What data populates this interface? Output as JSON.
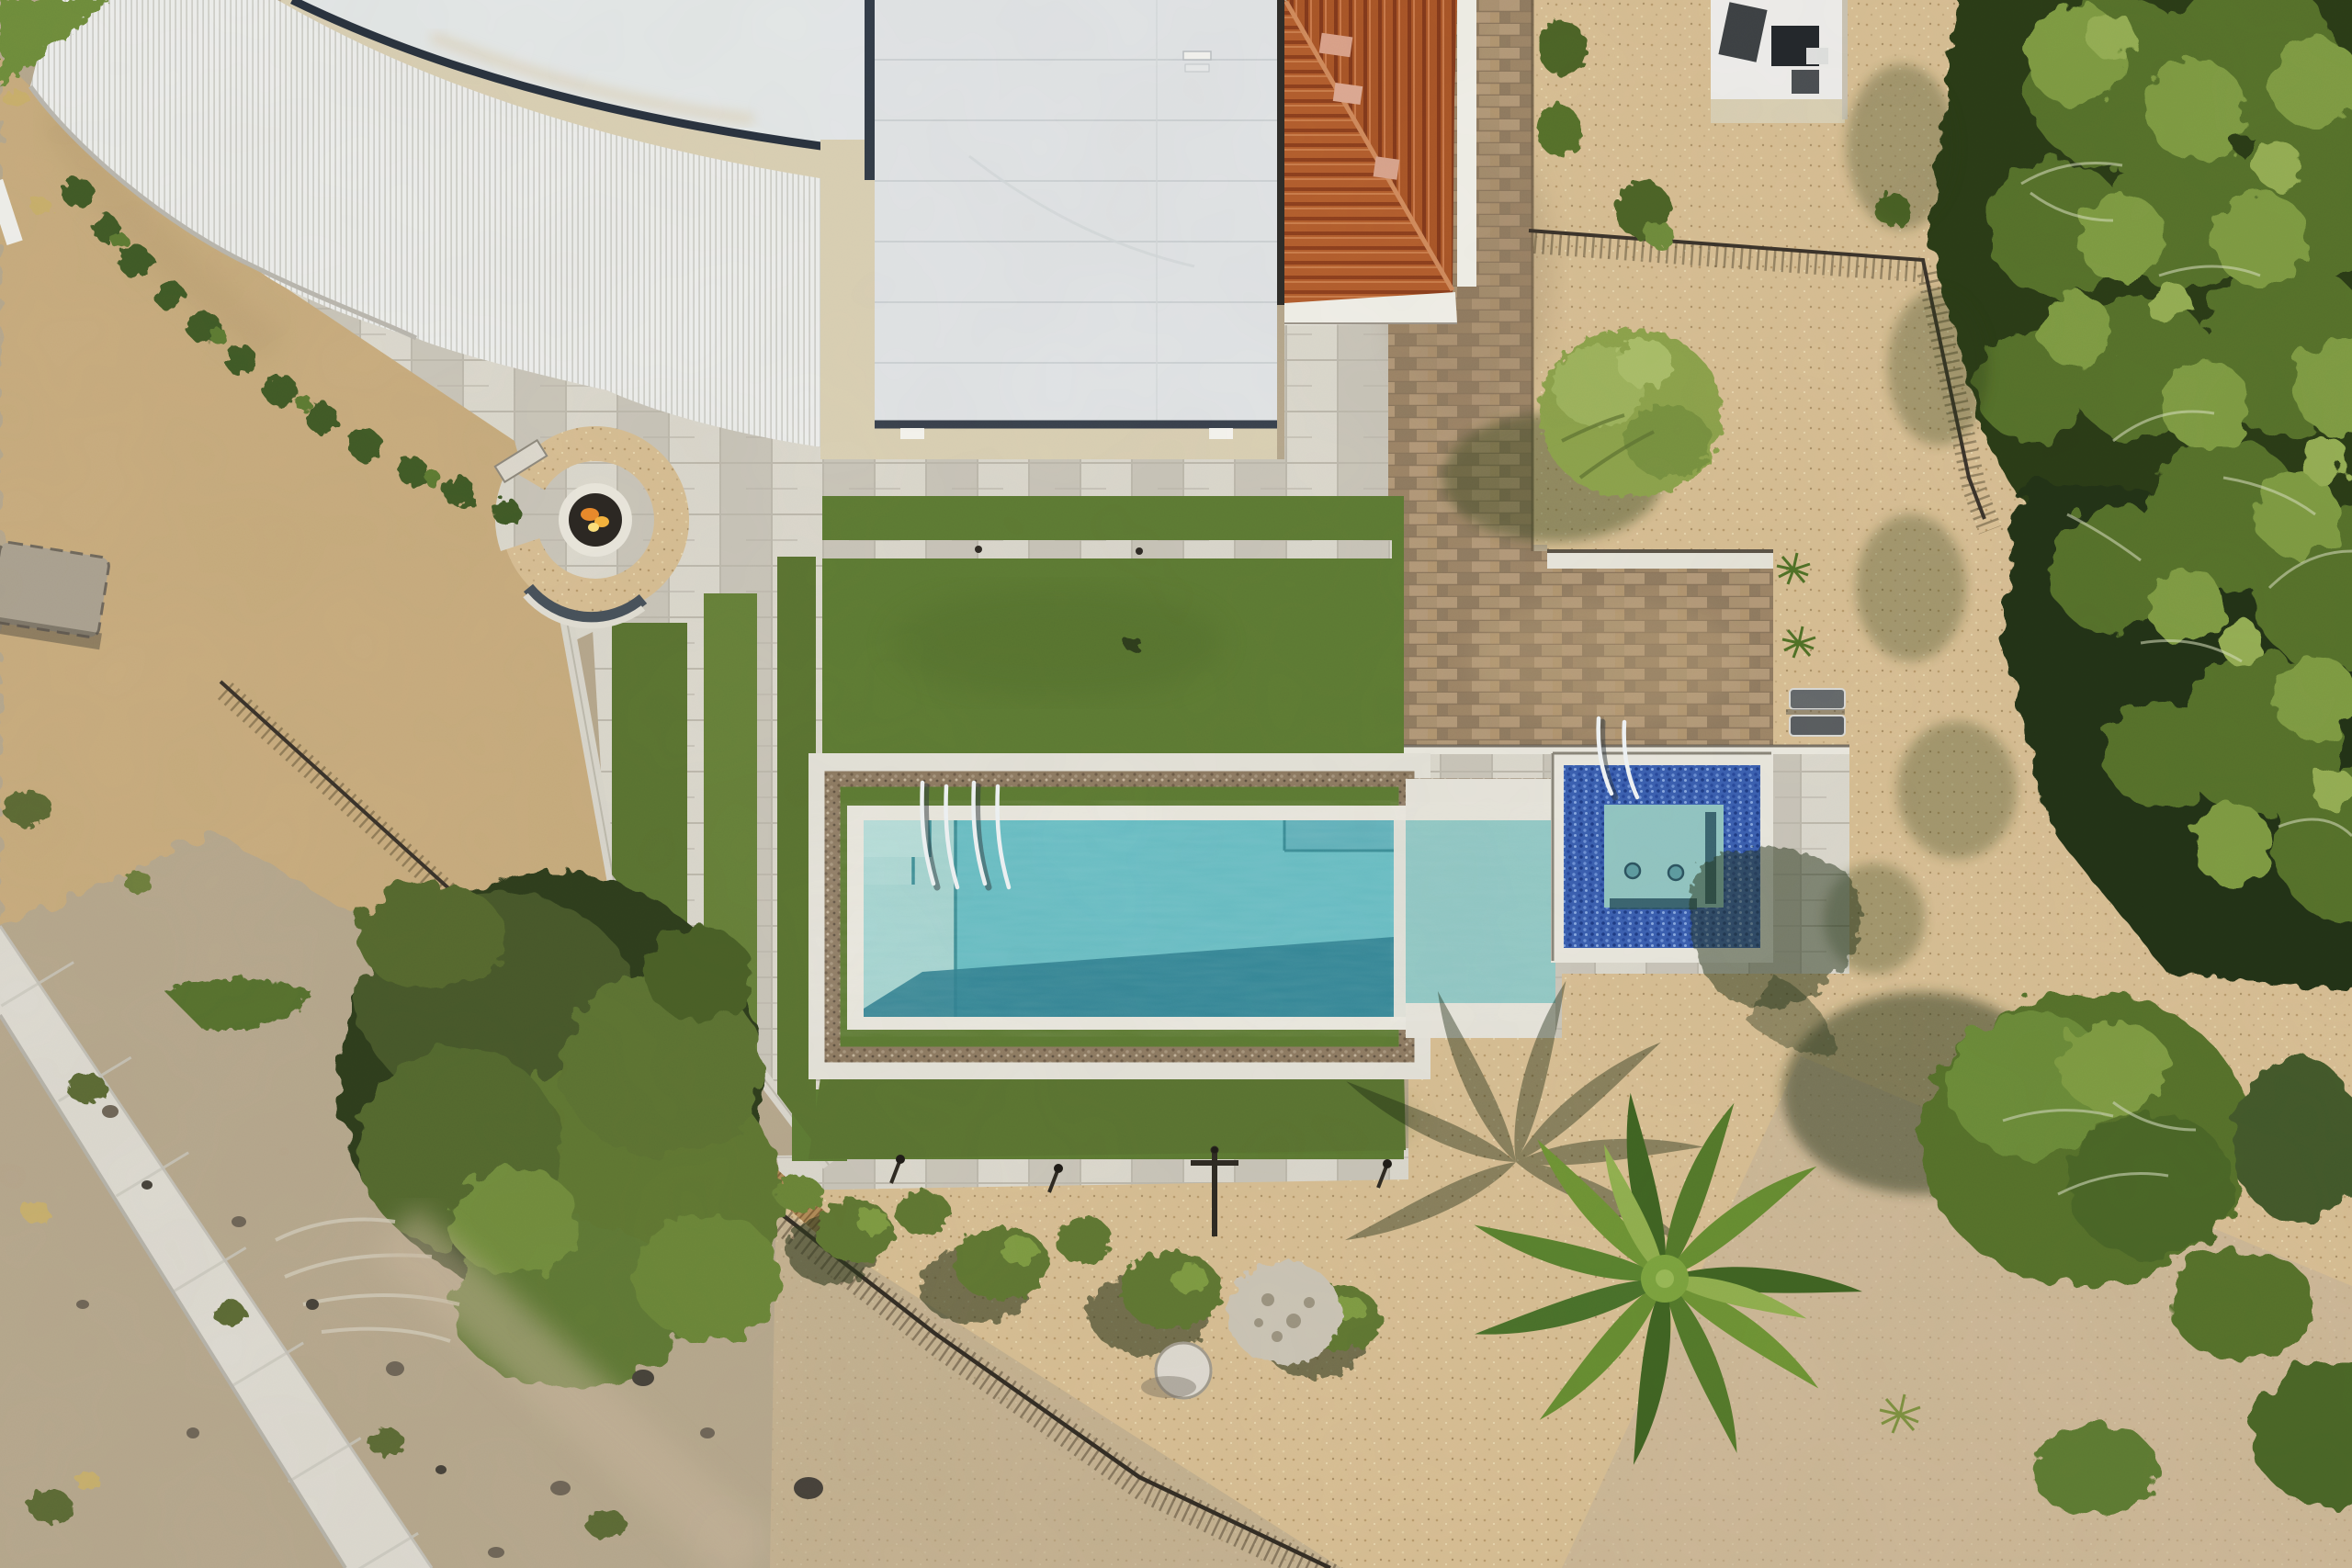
{
  "meta": {
    "title": "Aerial Property View",
    "caption": "Top-down aerial photograph of a modern desert home: curved white metal roof, flat membrane roof, terracotta hip roof, turquoise lap pool with baja shelf, royal-blue tiled spa, artificial turf terraces, travertine decks, paver patio, fire pit, palm and pine trees, desert gravel and concrete path."
  },
  "palette": {
    "desert_ground": "#b5a68c",
    "dirt_upper": "#c7ab7d",
    "gravel_dg": "#d6bd92",
    "path_concrete": "#dcd9d0",
    "travertine": "#d0cdc2",
    "trav_a": "#c8c4b8",
    "trav_b": "#dad7cc",
    "turf": "#5a7331",
    "turf_light": "#668039",
    "lawn": "#5d7a33",
    "paver": "#a58a6b",
    "paver_a": "#b29878",
    "paver_b": "#8f7a60",
    "roof_membrane": "#e0e3e5",
    "roof_canopy": "#ecedeb",
    "roof_pale": "#e3e7e7",
    "stucco_cream": "#d9cfb3",
    "roof_edge_dark": "#333c48",
    "terracotta": "#b25d2d",
    "terracotta_dark": "#8c3f1d",
    "fascia_white": "#efeee7",
    "pool_water": "#66bcc3",
    "pool_shelf": "#a3d3d0",
    "pool_deep": "#2c7d8e",
    "connector_water": "#8fc7c4",
    "pebble": "#8d7a62",
    "spa_tile": "#3a5fb0",
    "spa_water": "#90c4c1",
    "canopy_light": "#7d9a43",
    "canopy_mid": "#55702c",
    "canopy_dark": "#2a3a18",
    "bush_olive": "#5f7633",
    "fence_dark": "#3a332a",
    "reed_tan": "#b08a57",
    "flame": "#e8882a",
    "grass_corner": "#6e8c3a"
  },
  "scene": {
    "regions": [
      {
        "name": "curved-metal-roof",
        "label": "Curved ribbed white metal roof"
      },
      {
        "name": "pale-upper-roof",
        "label": "Smooth pale roof above curved gutter"
      },
      {
        "name": "flat-membrane-roof",
        "label": "Flat white membrane roof"
      },
      {
        "name": "terracotta-roof",
        "label": "Terracotta tile hip roof"
      },
      {
        "name": "outbuilding-roof",
        "label": "White outbuilding roof with equipment"
      },
      {
        "name": "paver-patio",
        "label": "Brown paver patio and walkway"
      },
      {
        "name": "gravel-yard",
        "label": "Decomposed granite gravel yard"
      },
      {
        "name": "travertine-patio",
        "label": "Travertine patio and pool deck"
      },
      {
        "name": "fire-pit",
        "label": "Round gas fire pit with gravel ring and curved bench"
      },
      {
        "name": "upper-lawn",
        "label": "Upper artificial turf lawn"
      },
      {
        "name": "turf-terraces",
        "label": "Stepped artificial turf terraces"
      },
      {
        "name": "lower-lawn",
        "label": "Lower artificial turf band"
      },
      {
        "name": "lap-pool",
        "label": "Turquoise lap pool with baja shelf and handrails"
      },
      {
        "name": "spa",
        "label": "Square spa with royal blue tile"
      },
      {
        "name": "connector-ledge",
        "label": "Shallow ledge between pool and spa"
      },
      {
        "name": "palm-tree",
        "label": "Large palm tree"
      },
      {
        "name": "pine-canopy",
        "label": "Pine tree canopy along right edge"
      },
      {
        "name": "desert-scrub",
        "label": "Native desert scrub and rocks"
      },
      {
        "name": "concrete-path",
        "label": "Concrete path, lower left"
      },
      {
        "name": "iron-fence",
        "label": "Black iron view fence"
      },
      {
        "name": "reed-fence",
        "label": "Rustic reed fence"
      },
      {
        "name": "hedge-row",
        "label": "Clipped hedge row along curved building"
      },
      {
        "name": "loungers",
        "label": "Two sun loungers"
      },
      {
        "name": "bollard-lights",
        "label": "Path bollard lights"
      }
    ]
  }
}
